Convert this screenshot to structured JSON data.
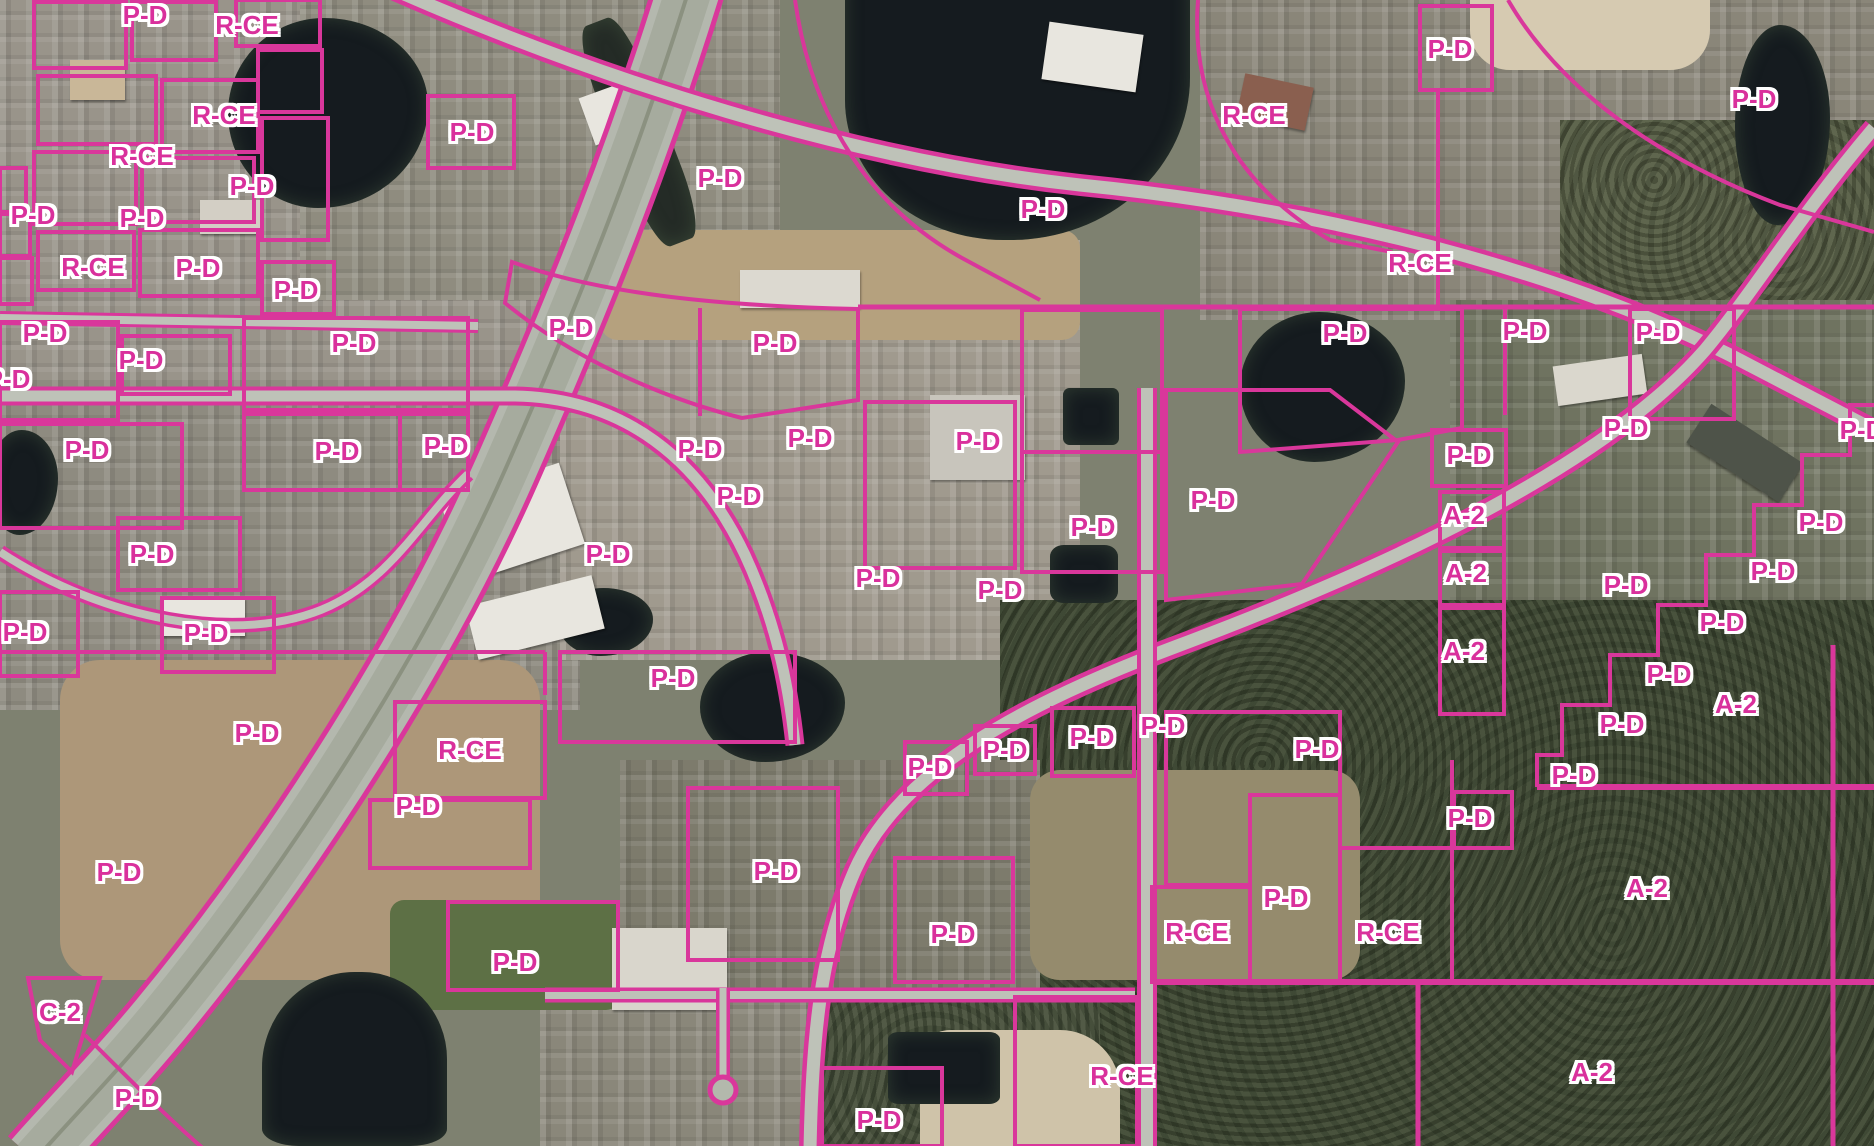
{
  "map": {
    "title": "Zoning district map over aerial imagery",
    "zone_codes": [
      "P-D",
      "R-CE",
      "A-2",
      "C-2"
    ],
    "colors": {
      "boundary": "#d9379b",
      "label_text": "#d9309c",
      "label_halo": "#ffffff",
      "road": "#b6bab0",
      "water": "#151b1f"
    },
    "labels": [
      {
        "t": "P-D",
        "x": 145,
        "y": 15
      },
      {
        "t": "R-CE",
        "x": 247,
        "y": 25
      },
      {
        "t": "R-CE",
        "x": 224,
        "y": 115
      },
      {
        "t": "R-CE",
        "x": 142,
        "y": 156
      },
      {
        "t": "P-D",
        "x": 252,
        "y": 186
      },
      {
        "t": "P-D",
        "x": 33,
        "y": 215
      },
      {
        "t": "P-D",
        "x": 142,
        "y": 218
      },
      {
        "t": "R-CE",
        "x": 93,
        "y": 267
      },
      {
        "t": "P-D",
        "x": 198,
        "y": 268
      },
      {
        "t": "P-D",
        "x": 296,
        "y": 290
      },
      {
        "t": "P-D",
        "x": 472,
        "y": 132
      },
      {
        "t": "P-D",
        "x": 720,
        "y": 178
      },
      {
        "t": "P-D",
        "x": 1043,
        "y": 209
      },
      {
        "t": "R-CE",
        "x": 1254,
        "y": 115
      },
      {
        "t": "R-CE",
        "x": 1420,
        "y": 263
      },
      {
        "t": "P-D",
        "x": 1450,
        "y": 49
      },
      {
        "t": "P-D",
        "x": 1754,
        "y": 99
      },
      {
        "t": "P-D",
        "x": 45,
        "y": 333
      },
      {
        "t": "P-D",
        "x": 141,
        "y": 360
      },
      {
        "t": "P-D",
        "x": 8,
        "y": 379
      },
      {
        "t": "P-D",
        "x": 354,
        "y": 343
      },
      {
        "t": "P-D",
        "x": 87,
        "y": 450
      },
      {
        "t": "P-D",
        "x": 337,
        "y": 451
      },
      {
        "t": "P-D",
        "x": 446,
        "y": 446
      },
      {
        "t": "P-D",
        "x": 152,
        "y": 554
      },
      {
        "t": "P-D",
        "x": 25,
        "y": 632
      },
      {
        "t": "P-D",
        "x": 206,
        "y": 633
      },
      {
        "t": "P-D",
        "x": 571,
        "y": 328
      },
      {
        "t": "P-D",
        "x": 775,
        "y": 343
      },
      {
        "t": "P-D",
        "x": 700,
        "y": 449
      },
      {
        "t": "P-D",
        "x": 810,
        "y": 438
      },
      {
        "t": "P-D",
        "x": 739,
        "y": 496
      },
      {
        "t": "P-D",
        "x": 608,
        "y": 554
      },
      {
        "t": "P-D",
        "x": 878,
        "y": 578
      },
      {
        "t": "P-D",
        "x": 978,
        "y": 441
      },
      {
        "t": "P-D",
        "x": 1000,
        "y": 590
      },
      {
        "t": "P-D",
        "x": 1345,
        "y": 333
      },
      {
        "t": "P-D",
        "x": 1525,
        "y": 331
      },
      {
        "t": "P-D",
        "x": 1658,
        "y": 332
      },
      {
        "t": "P-D",
        "x": 1469,
        "y": 455
      },
      {
        "t": "P-D",
        "x": 1626,
        "y": 428
      },
      {
        "t": "P-D",
        "x": 1862,
        "y": 430
      },
      {
        "t": "P-D",
        "x": 1213,
        "y": 500
      },
      {
        "t": "P-D",
        "x": 1093,
        "y": 527
      },
      {
        "t": "A-2",
        "x": 1464,
        "y": 515
      },
      {
        "t": "A-2",
        "x": 1466,
        "y": 573
      },
      {
        "t": "A-2",
        "x": 1464,
        "y": 651
      },
      {
        "t": "P-D",
        "x": 1821,
        "y": 522
      },
      {
        "t": "P-D",
        "x": 1773,
        "y": 571
      },
      {
        "t": "P-D",
        "x": 1722,
        "y": 622
      },
      {
        "t": "P-D",
        "x": 1669,
        "y": 674
      },
      {
        "t": "P-D",
        "x": 1622,
        "y": 724
      },
      {
        "t": "P-D",
        "x": 1574,
        "y": 775
      },
      {
        "t": "P-D",
        "x": 1626,
        "y": 585
      },
      {
        "t": "A-2",
        "x": 1736,
        "y": 704
      },
      {
        "t": "A-2",
        "x": 1647,
        "y": 888
      },
      {
        "t": "P-D",
        "x": 257,
        "y": 733
      },
      {
        "t": "R-CE",
        "x": 470,
        "y": 750
      },
      {
        "t": "P-D",
        "x": 418,
        "y": 806
      },
      {
        "t": "P-D",
        "x": 119,
        "y": 872
      },
      {
        "t": "P-D",
        "x": 515,
        "y": 962
      },
      {
        "t": "P-D",
        "x": 673,
        "y": 678
      },
      {
        "t": "P-D",
        "x": 930,
        "y": 767
      },
      {
        "t": "P-D",
        "x": 1005,
        "y": 750
      },
      {
        "t": "P-D",
        "x": 776,
        "y": 871
      },
      {
        "t": "P-D",
        "x": 953,
        "y": 934
      },
      {
        "t": "P-D",
        "x": 1092,
        "y": 737
      },
      {
        "t": "P-D",
        "x": 1163,
        "y": 726
      },
      {
        "t": "P-D",
        "x": 1317,
        "y": 749
      },
      {
        "t": "P-D",
        "x": 1470,
        "y": 818
      },
      {
        "t": "P-D",
        "x": 1286,
        "y": 898
      },
      {
        "t": "R-CE",
        "x": 1197,
        "y": 932
      },
      {
        "t": "R-CE",
        "x": 1388,
        "y": 932
      },
      {
        "t": "C-2",
        "x": 60,
        "y": 1012
      },
      {
        "t": "P-D",
        "x": 137,
        "y": 1098
      },
      {
        "t": "P-D",
        "x": 879,
        "y": 1120
      },
      {
        "t": "R-CE",
        "x": 1122,
        "y": 1076
      },
      {
        "t": "A-2",
        "x": 1592,
        "y": 1072
      }
    ]
  }
}
